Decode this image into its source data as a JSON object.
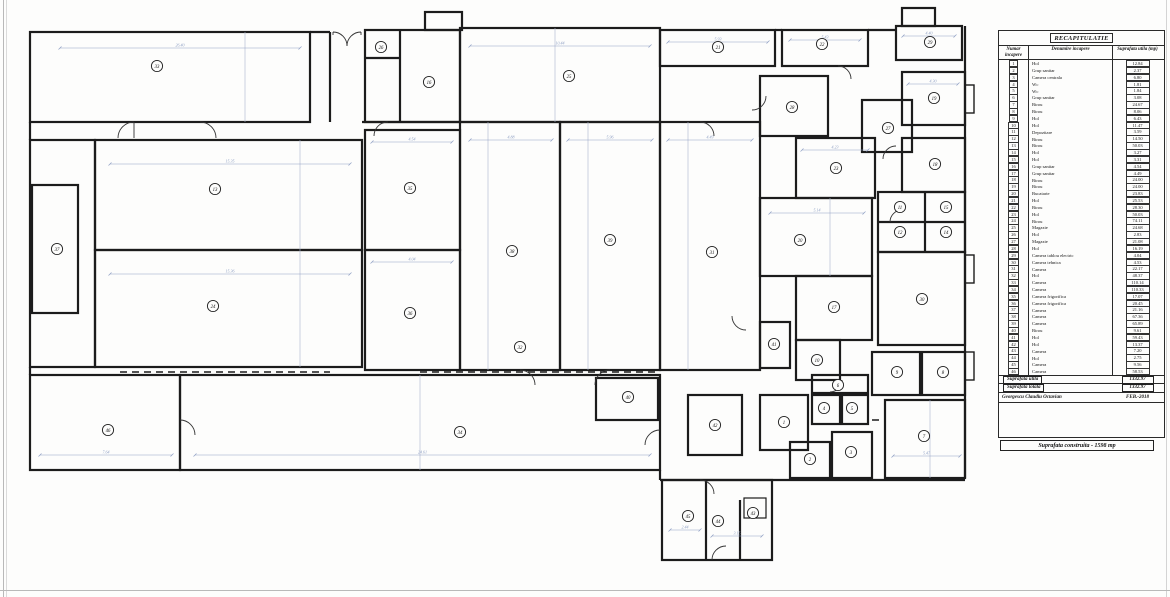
{
  "table": {
    "title": "RECAPITULATIE",
    "headers": [
      "Numar incapere",
      "Denumire incapere",
      "Suprafata utila (mp)"
    ],
    "rows": [
      [
        "1",
        "Hol",
        "12.84"
      ],
      [
        "2",
        "Grup sanitar",
        "2.37"
      ],
      [
        "3",
        "Camera centrala",
        "6.80"
      ],
      [
        "4",
        "Wc",
        "1.81"
      ],
      [
        "5",
        "Wc",
        "1.84"
      ],
      [
        "6",
        "Grup sanitar",
        "3.08"
      ],
      [
        "7",
        "Birou",
        "24.67"
      ],
      [
        "8",
        "Birou",
        "8.06"
      ],
      [
        "9",
        "Hol",
        "6.43"
      ],
      [
        "10",
        "Hol",
        "11.47"
      ],
      [
        "11",
        "Depozitare",
        "3.59"
      ],
      [
        "12",
        "Birou",
        "14.50"
      ],
      [
        "13",
        "Birou",
        "50.03"
      ],
      [
        "14",
        "Hol",
        "3.27"
      ],
      [
        "15",
        "Hol",
        "3.31"
      ],
      [
        "16",
        "Grup sanitar",
        "4.54"
      ],
      [
        "17",
        "Grup sanitar",
        "4.49"
      ],
      [
        "18",
        "Birou",
        "24.00"
      ],
      [
        "19",
        "Birou",
        "24.00"
      ],
      [
        "20",
        "Bucatarie",
        "23.83"
      ],
      [
        "21",
        "Hol",
        "25.53"
      ],
      [
        "22",
        "Birou",
        "28.30"
      ],
      [
        "23",
        "Hol",
        "50.03"
      ],
      [
        "24",
        "Birou",
        "74.11"
      ],
      [
        "25",
        "Magazie",
        "24.68"
      ],
      [
        "26",
        "Hol",
        "2.83"
      ],
      [
        "27",
        "Magazie",
        "21.08"
      ],
      [
        "28",
        "Hol",
        "16.19"
      ],
      [
        "29",
        "Camera tablou electric",
        "4.04"
      ],
      [
        "30",
        "Camera tehnica",
        "4.53"
      ],
      [
        "31",
        "Camera",
        "22.17"
      ],
      [
        "32",
        "Hol",
        "48.37"
      ],
      [
        "33",
        "Camera",
        "110.14"
      ],
      [
        "34",
        "Camera",
        "110.33"
      ],
      [
        "35",
        "Camera frigorifica",
        "17.07"
      ],
      [
        "36",
        "Camera frigorifica",
        "20.45"
      ],
      [
        "37",
        "Camera",
        "21.16"
      ],
      [
        "38",
        "Camera",
        "67.36"
      ],
      [
        "39",
        "Camera",
        "65.89"
      ],
      [
        "40",
        "Birou",
        "9.61"
      ],
      [
        "41",
        "Hol",
        "59.43"
      ],
      [
        "42",
        "Hol",
        "13.37"
      ],
      [
        "43",
        "Camera",
        "7.20"
      ],
      [
        "44",
        "Hol",
        "2.75"
      ],
      [
        "45",
        "Camera",
        "9.56"
      ],
      [
        "46",
        "Camera",
        "58.53"
      ]
    ],
    "summary": [
      {
        "label": "Suprafata utila",
        "value": "1332.97"
      },
      {
        "label": "Suprafata totala",
        "value": "1332.97"
      }
    ],
    "signature": {
      "name": "Georgescu Claudiu Octavian",
      "date": "FEB.-2018"
    }
  },
  "footer": {
    "built_area": "Suprafata construita - 1598 mp"
  },
  "plan": {
    "room_circles": [
      {
        "n": "33",
        "x": 157,
        "y": 66
      },
      {
        "n": "13",
        "x": 215,
        "y": 189
      },
      {
        "n": "24",
        "x": 213,
        "y": 306
      },
      {
        "n": "46",
        "x": 108,
        "y": 430
      },
      {
        "n": "34",
        "x": 460,
        "y": 432
      },
      {
        "n": "37",
        "x": 57,
        "y": 249
      },
      {
        "n": "26",
        "x": 381,
        "y": 47
      },
      {
        "n": "16",
        "x": 429,
        "y": 82
      },
      {
        "n": "25",
        "x": 569,
        "y": 76
      },
      {
        "n": "35",
        "x": 410,
        "y": 188
      },
      {
        "n": "36",
        "x": 410,
        "y": 313
      },
      {
        "n": "38",
        "x": 512,
        "y": 251
      },
      {
        "n": "39",
        "x": 610,
        "y": 240
      },
      {
        "n": "31",
        "x": 712,
        "y": 252
      },
      {
        "n": "21",
        "x": 718,
        "y": 47
      },
      {
        "n": "22",
        "x": 822,
        "y": 44
      },
      {
        "n": "29",
        "x": 930,
        "y": 42
      },
      {
        "n": "28",
        "x": 792,
        "y": 107
      },
      {
        "n": "19",
        "x": 934,
        "y": 98
      },
      {
        "n": "27",
        "x": 888,
        "y": 128
      },
      {
        "n": "18",
        "x": 935,
        "y": 164
      },
      {
        "n": "23",
        "x": 836,
        "y": 168
      },
      {
        "n": "20",
        "x": 800,
        "y": 240
      },
      {
        "n": "17",
        "x": 834,
        "y": 307
      },
      {
        "n": "30",
        "x": 922,
        "y": 299
      },
      {
        "n": "11",
        "x": 900,
        "y": 207
      },
      {
        "n": "15",
        "x": 946,
        "y": 207
      },
      {
        "n": "12",
        "x": 900,
        "y": 232
      },
      {
        "n": "14",
        "x": 946,
        "y": 232
      },
      {
        "n": "41",
        "x": 774,
        "y": 344
      },
      {
        "n": "10",
        "x": 817,
        "y": 360
      },
      {
        "n": "9",
        "x": 897,
        "y": 372
      },
      {
        "n": "8",
        "x": 943,
        "y": 372
      },
      {
        "n": "40",
        "x": 628,
        "y": 397
      },
      {
        "n": "42",
        "x": 715,
        "y": 425
      },
      {
        "n": "32",
        "x": 520,
        "y": 347
      },
      {
        "n": "1",
        "x": 784,
        "y": 422
      },
      {
        "n": "2",
        "x": 810,
        "y": 459
      },
      {
        "n": "3",
        "x": 851,
        "y": 452
      },
      {
        "n": "4",
        "x": 824,
        "y": 408
      },
      {
        "n": "5",
        "x": 852,
        "y": 408
      },
      {
        "n": "6",
        "x": 838,
        "y": 385
      },
      {
        "n": "7",
        "x": 924,
        "y": 436
      },
      {
        "n": "45",
        "x": 688,
        "y": 516
      },
      {
        "n": "44",
        "x": 718,
        "y": 521
      },
      {
        "n": "43",
        "x": 753,
        "y": 513
      }
    ],
    "dims": [
      {
        "x1": 60,
        "y": 48,
        "x2": 300,
        "label": "26.40"
      },
      {
        "x1": 110,
        "y": 164,
        "x2": 350,
        "label": "15.35"
      },
      {
        "x1": 110,
        "y": 274,
        "x2": 350,
        "label": "15.36"
      },
      {
        "x1": 195,
        "y": 455,
        "x2": 650,
        "label": "24.61"
      },
      {
        "x1": 40,
        "y": 455,
        "x2": 172,
        "label": "7.64"
      },
      {
        "x1": 470,
        "y": 46,
        "x2": 650,
        "label": "10.44"
      },
      {
        "x1": 470,
        "y": 140,
        "x2": 552,
        "label": "4.88"
      },
      {
        "x1": 568,
        "y": 140,
        "x2": 652,
        "label": "5.96"
      },
      {
        "x1": 668,
        "y": 140,
        "x2": 752,
        "label": "4.49"
      },
      {
        "x1": 668,
        "y": 42,
        "x2": 768,
        "label": "5.93"
      },
      {
        "x1": 790,
        "y": 40,
        "x2": 860,
        "label": "5.43"
      },
      {
        "x1": 903,
        "y": 36,
        "x2": 955,
        "label": "4.40"
      },
      {
        "x1": 770,
        "y": 213,
        "x2": 864,
        "label": "5.14"
      },
      {
        "x1": 802,
        "y": 150,
        "x2": 868,
        "label": "4.23"
      },
      {
        "x1": 908,
        "y": 84,
        "x2": 958,
        "label": "4.30"
      },
      {
        "x1": 893,
        "y": 456,
        "x2": 960,
        "label": "5.47"
      },
      {
        "x1": 372,
        "y": 142,
        "x2": 452,
        "label": "4.54"
      },
      {
        "x1": 372,
        "y": 262,
        "x2": 452,
        "label": "4.04"
      },
      {
        "x1": 670,
        "y": 530,
        "x2": 700,
        "label": "2.44"
      },
      {
        "x1": 712,
        "y": 536,
        "x2": 762,
        "label": "3.15"
      }
    ]
  },
  "colors": {
    "wall": "#1c1c1c",
    "dim": "#8fa0c4",
    "paper": "#fdfdfc"
  }
}
